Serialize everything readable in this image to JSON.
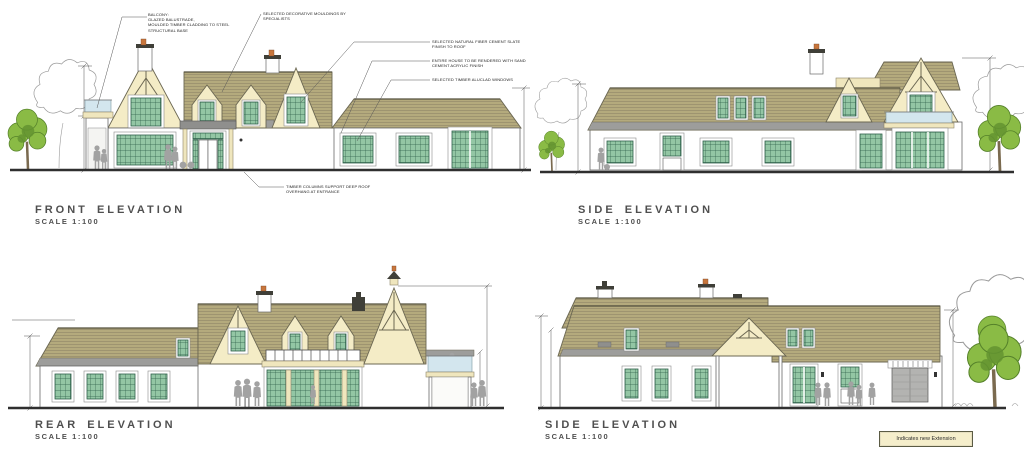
{
  "sheet": {
    "background": "#ffffff",
    "elevations": [
      {
        "key": "front",
        "title": "FRONT ELEVATION",
        "scale": "SCALE 1:100"
      },
      {
        "key": "side_upper",
        "title": "SIDE ELEVATION",
        "scale": "SCALE 1:100"
      },
      {
        "key": "rear",
        "title": "REAR ELEVATION",
        "scale": "SCALE 1:100"
      },
      {
        "key": "side_lower",
        "title": "SIDE ELEVATION",
        "scale": "SCALE 1:100"
      }
    ],
    "annotations": {
      "balcony": "BALCONY:\nGLAZED BALUSTRADE,\nMOULDED TIMBER CLADDING TO STEEL\nSTRUCTURAL BASE",
      "mouldings": "SELECTED DECORATIVE MOULDINGS BY\nSPECIALISTS",
      "roof_finish": "SELECTED NATURAL FIBER CEMENT SLATE\nFINISH TO ROOF",
      "render_finish": "ENTIRE HOUSE TO BE RENDERED WITH SAND\nCEMENT ACRYLIC FINISH",
      "windows": "SELECTED TIMBER ALUCLAD WINDOWS",
      "entrance": "TIMBER COLUMNS SUPPORT DEEP ROOF\nOVERHANG AT ENTRANCE"
    },
    "legend": {
      "label": "Indicates new Extension"
    },
    "palette": {
      "roof_slate": "#b4aa7d",
      "roof_eaves_gray": "#9d9d9b",
      "gable_render_cream": "#f4ecc6",
      "wall_render_white": "#ffffff",
      "window_glass_green": "#93c6a4",
      "window_frame_green": "#2e5f49",
      "balcony_glass_blue": "#d3e6ee",
      "tree_foliage_green": "#8abb45",
      "figure_gray": "#a2a2a2",
      "chimney_pot_terracotta": "#c8763c",
      "title_gray": "#4f4f4f",
      "legend_fill_cream": "#f5eecb"
    }
  }
}
